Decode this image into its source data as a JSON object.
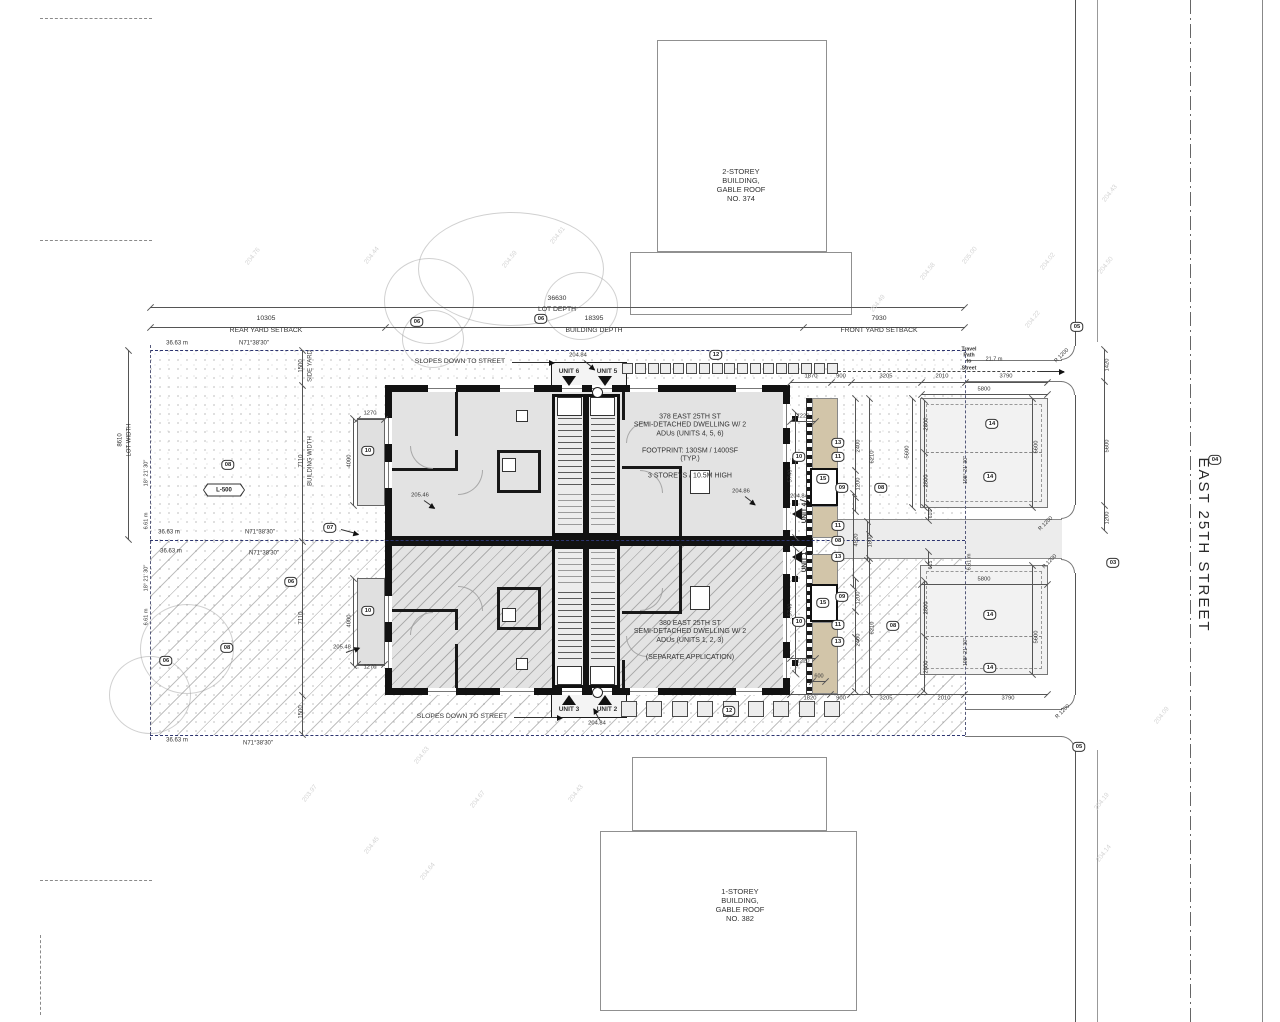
{
  "street": {
    "name": "EAST 25TH STREET"
  },
  "neighbors": {
    "north": "2-STOREY\nBUILDING,\nGABLE ROOF\nNO. 374",
    "south": "1-STOREY\nBUILDING,\nGABLE ROOF\nNO. 382"
  },
  "buildings": {
    "north": {
      "text": "378 EAST 25TH ST\nSEMI-DETACHED DWELLING W/ 2\nADUs (UNITS 4, 5, 6)\n\nFOOTPRINT: 130SM / 1400SF\n(TYP.)\n\n3 STOREYS / 10.5M HIGH"
    },
    "south": {
      "text": "380 EAST 25TH ST\nSEMI-DETACHED DWELLING W/ 2\nADUs (UNITS 1, 2, 3)\n\n(SEPARATE APPLICATION)"
    }
  },
  "travel": {
    "label": "Travel\nPath\nto\nStreet",
    "distance": "21.7 m"
  },
  "labels": [
    {
      "t": "36630",
      "x": 557,
      "y": 299
    },
    {
      "t": "LOT DEPTH",
      "x": 557,
      "y": 310
    },
    {
      "t": "10305",
      "x": 266,
      "y": 319
    },
    {
      "t": "REAR YARD SETBACK",
      "x": 266,
      "y": 331
    },
    {
      "t": "18395",
      "x": 594,
      "y": 319
    },
    {
      "t": "BUILDING DEPTH",
      "x": 594,
      "y": 331
    },
    {
      "t": "7930",
      "x": 879,
      "y": 319
    },
    {
      "t": "FRONT YARD SETBACK",
      "x": 879,
      "y": 331
    },
    {
      "t": "36.63 m",
      "x": 177,
      "y": 344,
      "s": 6
    },
    {
      "t": "N71°38'30\"",
      "x": 254,
      "y": 344,
      "s": 6
    },
    {
      "t": "36.63 m",
      "x": 169,
      "y": 533,
      "s": 6
    },
    {
      "t": "N71°38'30\"",
      "x": 260,
      "y": 533,
      "s": 6
    },
    {
      "t": "36.63 m",
      "x": 171,
      "y": 552,
      "s": 6
    },
    {
      "t": "N71°38'30\"",
      "x": 264,
      "y": 554,
      "s": 6
    },
    {
      "t": "36.63 m",
      "x": 177,
      "y": 741,
      "s": 6
    },
    {
      "t": "N71°38'30\"",
      "x": 258,
      "y": 744,
      "s": 6
    },
    {
      "t": "8610",
      "x": 121,
      "y": 440,
      "r": -90,
      "s": 6
    },
    {
      "t": "LOT WIDTH",
      "x": 130,
      "y": 440,
      "r": -90,
      "s": 6
    },
    {
      "t": "18° 21' 30\"",
      "x": 147,
      "y": 473,
      "r": -90,
      "s": 5.5
    },
    {
      "t": "6.61 m",
      "x": 147,
      "y": 521,
      "r": -90,
      "s": 5.5
    },
    {
      "t": "18° 21' 30\"",
      "x": 147,
      "y": 578,
      "r": -90,
      "s": 5.5
    },
    {
      "t": "6.61 m",
      "x": 147,
      "y": 617,
      "r": -90,
      "s": 5.5
    },
    {
      "t": "6.61 m",
      "x": 970,
      "y": 562,
      "r": -90,
      "s": 5.5
    },
    {
      "t": "1500",
      "x": 302,
      "y": 366,
      "r": -90,
      "s": 6
    },
    {
      "t": "SIDE YARD",
      "x": 311,
      "y": 366,
      "r": -90,
      "s": 6
    },
    {
      "t": "7110",
      "x": 302,
      "y": 461,
      "r": -90,
      "s": 6
    },
    {
      "t": "BUILDING WIDTH",
      "x": 311,
      "y": 461,
      "r": -90,
      "s": 6
    },
    {
      "t": "7110",
      "x": 302,
      "y": 618,
      "r": -90,
      "s": 6
    },
    {
      "t": "1500",
      "x": 302,
      "y": 712,
      "r": -90,
      "s": 6
    },
    {
      "t": "SLOPES DOWN TO STREET",
      "x": 460,
      "y": 362
    },
    {
      "t": "SLOPES DOWN TO STREET",
      "x": 462,
      "y": 717
    },
    {
      "t": "UNIT 6",
      "x": 569,
      "y": 372,
      "s": 6.5,
      "b": 1
    },
    {
      "t": "UNIT 5",
      "x": 607,
      "y": 372,
      "s": 6.5,
      "b": 1
    },
    {
      "t": "UNIT 3",
      "x": 569,
      "y": 710,
      "s": 6.5,
      "b": 1
    },
    {
      "t": "UNIT 2",
      "x": 607,
      "y": 710,
      "s": 6.5,
      "b": 1
    },
    {
      "t": "UNIT 4",
      "x": 805,
      "y": 513,
      "r": -90,
      "s": 6.5,
      "b": 1
    },
    {
      "t": "UNIT 1",
      "x": 805,
      "y": 562,
      "r": -90,
      "s": 6.5,
      "b": 1
    },
    {
      "t": "204.84",
      "x": 578,
      "y": 356,
      "s": 5.8
    },
    {
      "t": "204.86",
      "x": 741,
      "y": 492,
      "s": 5.8
    },
    {
      "t": "204.84",
      "x": 799,
      "y": 497,
      "s": 5.8
    },
    {
      "t": "205.46",
      "x": 420,
      "y": 496,
      "s": 5.8
    },
    {
      "t": "205.48",
      "x": 342,
      "y": 648,
      "s": 5.8
    },
    {
      "t": "204.84",
      "x": 597,
      "y": 724,
      "s": 5.8
    },
    {
      "t": "1220",
      "x": 803,
      "y": 417,
      "s": 5.8
    },
    {
      "t": "5740",
      "x": 791,
      "y": 476,
      "r": -90,
      "s": 5.8
    },
    {
      "t": "1220",
      "x": 803,
      "y": 662,
      "s": 5.8
    },
    {
      "t": "5740",
      "x": 791,
      "y": 610,
      "r": -90,
      "s": 5.8
    },
    {
      "t": "2400",
      "x": 859,
      "y": 446,
      "r": -90,
      "s": 5.8
    },
    {
      "t": "1200",
      "x": 859,
      "y": 484,
      "r": -90,
      "s": 5.8
    },
    {
      "t": "6210",
      "x": 873,
      "y": 457,
      "r": -90,
      "s": 5.8
    },
    {
      "t": "4520",
      "x": 857,
      "y": 540,
      "r": -90,
      "s": 5.8
    },
    {
      "t": "1800",
      "x": 871,
      "y": 541,
      "r": -90,
      "s": 5.8
    },
    {
      "t": "1200",
      "x": 859,
      "y": 598,
      "r": -90,
      "s": 5.8
    },
    {
      "t": "2400",
      "x": 859,
      "y": 640,
      "r": -90,
      "s": 5.8
    },
    {
      "t": "6210",
      "x": 873,
      "y": 628,
      "r": -90,
      "s": 5.8
    },
    {
      "t": "600",
      "x": 819,
      "y": 677,
      "s": 5.5
    },
    {
      "t": "1870",
      "x": 811,
      "y": 377,
      "s": 5.8
    },
    {
      "t": "900",
      "x": 841,
      "y": 377,
      "s": 5.8
    },
    {
      "t": "3205",
      "x": 886,
      "y": 377,
      "s": 5.8
    },
    {
      "t": "2010",
      "x": 942,
      "y": 377,
      "s": 5.8
    },
    {
      "t": "3790",
      "x": 1006,
      "y": 377,
      "s": 5.8
    },
    {
      "t": "5800",
      "x": 984,
      "y": 390,
      "s": 5.8
    },
    {
      "t": "1820",
      "x": 810,
      "y": 699,
      "s": 5.8
    },
    {
      "t": "900",
      "x": 841,
      "y": 699,
      "s": 5.8
    },
    {
      "t": "3205",
      "x": 886,
      "y": 699,
      "s": 5.8
    },
    {
      "t": "2010",
      "x": 944,
      "y": 699,
      "s": 5.8
    },
    {
      "t": "3790",
      "x": 1008,
      "y": 699,
      "s": 5.8
    },
    {
      "t": "5800",
      "x": 984,
      "y": 580,
      "s": 5.8
    },
    {
      "t": "2800",
      "x": 927,
      "y": 424,
      "r": -90,
      "s": 5.8
    },
    {
      "t": "2800",
      "x": 927,
      "y": 481,
      "r": -90,
      "s": 5.8
    },
    {
      "t": "5600",
      "x": 1037,
      "y": 447,
      "r": -90,
      "s": 5.8
    },
    {
      "t": "5600",
      "x": 908,
      "y": 452,
      "r": -90,
      "s": 5.8
    },
    {
      "t": "610",
      "x": 931,
      "y": 514,
      "r": -90,
      "s": 5.2
    },
    {
      "t": "615",
      "x": 931,
      "y": 565,
      "r": -90,
      "s": 5.2
    },
    {
      "t": "2800",
      "x": 927,
      "y": 608,
      "r": -90,
      "s": 5.8
    },
    {
      "t": "2800",
      "x": 927,
      "y": 667,
      "r": -90,
      "s": 5.8
    },
    {
      "t": "5600",
      "x": 1037,
      "y": 637,
      "r": -90,
      "s": 5.8
    },
    {
      "t": "198° 21' 30\"",
      "x": 966,
      "y": 470,
      "r": -90,
      "s": 5.2
    },
    {
      "t": "198° 21' 30\"",
      "x": 966,
      "y": 652,
      "r": -90,
      "s": 5.2
    },
    {
      "t": "1270",
      "x": 370,
      "y": 414,
      "s": 5.8
    },
    {
      "t": "4000",
      "x": 350,
      "y": 461,
      "r": -90,
      "s": 5.8
    },
    {
      "t": "1270",
      "x": 370,
      "y": 668,
      "s": 5.8
    },
    {
      "t": "4000",
      "x": 350,
      "y": 621,
      "r": -90,
      "s": 5.8
    },
    {
      "t": "1420",
      "x": 1108,
      "y": 365,
      "r": -90,
      "s": 5.8
    },
    {
      "t": "5600",
      "x": 1108,
      "y": 446,
      "r": -90,
      "s": 5.8
    },
    {
      "t": "1200",
      "x": 1108,
      "y": 518,
      "r": -90,
      "s": 5.8
    },
    {
      "t": "R 1200",
      "x": 1062,
      "y": 356,
      "r": -45,
      "s": 5.5
    },
    {
      "t": "R 1200",
      "x": 1046,
      "y": 524,
      "r": -45,
      "s": 5.5
    },
    {
      "t": "R 1200",
      "x": 1050,
      "y": 562,
      "r": -45,
      "s": 5.5
    },
    {
      "t": "R 1200",
      "x": 1063,
      "y": 712,
      "r": -45,
      "s": 5.5
    }
  ],
  "keynotes": [
    {
      "n": "06",
      "x": 417,
      "y": 322
    },
    {
      "n": "06",
      "x": 541,
      "y": 319
    },
    {
      "n": "08",
      "x": 228,
      "y": 465
    },
    {
      "n": "L-500",
      "x": 224,
      "y": 490,
      "hex": 1
    },
    {
      "n": "07",
      "x": 330,
      "y": 528
    },
    {
      "n": "06",
      "x": 291,
      "y": 582
    },
    {
      "n": "08",
      "x": 227,
      "y": 648
    },
    {
      "n": "06",
      "x": 166,
      "y": 661
    },
    {
      "n": "12",
      "x": 716,
      "y": 355
    },
    {
      "n": "12",
      "x": 729,
      "y": 711
    },
    {
      "n": "10",
      "x": 368,
      "y": 451
    },
    {
      "n": "10",
      "x": 368,
      "y": 611
    },
    {
      "n": "10",
      "x": 799,
      "y": 457
    },
    {
      "n": "10",
      "x": 799,
      "y": 622
    },
    {
      "n": "13",
      "x": 838,
      "y": 443
    },
    {
      "n": "11",
      "x": 838,
      "y": 457
    },
    {
      "n": "15",
      "x": 823,
      "y": 479
    },
    {
      "n": "09",
      "x": 842,
      "y": 488
    },
    {
      "n": "08",
      "x": 881,
      "y": 488
    },
    {
      "n": "11",
      "x": 838,
      "y": 526
    },
    {
      "n": "08",
      "x": 838,
      "y": 541
    },
    {
      "n": "13",
      "x": 838,
      "y": 557
    },
    {
      "n": "09",
      "x": 842,
      "y": 597
    },
    {
      "n": "15",
      "x": 823,
      "y": 603
    },
    {
      "n": "11",
      "x": 838,
      "y": 625
    },
    {
      "n": "13",
      "x": 838,
      "y": 642
    },
    {
      "n": "14",
      "x": 992,
      "y": 424
    },
    {
      "n": "14",
      "x": 990,
      "y": 477
    },
    {
      "n": "14",
      "x": 990,
      "y": 615
    },
    {
      "n": "14",
      "x": 990,
      "y": 668
    },
    {
      "n": "08",
      "x": 893,
      "y": 626
    },
    {
      "n": "05",
      "x": 1077,
      "y": 327
    },
    {
      "n": "04",
      "x": 1215,
      "y": 460
    },
    {
      "n": "03",
      "x": 1113,
      "y": 563
    },
    {
      "n": "05",
      "x": 1079,
      "y": 747
    }
  ],
  "marks": [
    {
      "t": "204.76",
      "x": 243,
      "y": 253
    },
    {
      "t": "204.44",
      "x": 362,
      "y": 252
    },
    {
      "t": "204.59",
      "x": 500,
      "y": 256
    },
    {
      "t": "204.61",
      "x": 548,
      "y": 232
    },
    {
      "t": "204.49",
      "x": 868,
      "y": 300
    },
    {
      "t": "204.58",
      "x": 918,
      "y": 268
    },
    {
      "t": "204.22",
      "x": 1023,
      "y": 316
    },
    {
      "t": "204.43",
      "x": 1100,
      "y": 190
    },
    {
      "t": "204.50",
      "x": 1096,
      "y": 262
    },
    {
      "t": "203.97",
      "x": 300,
      "y": 790
    },
    {
      "t": "204.63",
      "x": 412,
      "y": 752
    },
    {
      "t": "204.45",
      "x": 362,
      "y": 842
    },
    {
      "t": "204.67",
      "x": 468,
      "y": 796
    },
    {
      "t": "204.64",
      "x": 418,
      "y": 868
    },
    {
      "t": "204.43",
      "x": 566,
      "y": 790
    },
    {
      "t": "204.19",
      "x": 1092,
      "y": 798
    },
    {
      "t": "204.14",
      "x": 1094,
      "y": 850
    },
    {
      "t": "204.09",
      "x": 1152,
      "y": 712
    },
    {
      "t": "205.00",
      "x": 960,
      "y": 252
    },
    {
      "t": "204.02",
      "x": 1038,
      "y": 258
    }
  ],
  "trees": [
    {
      "x": 510,
      "y": 268,
      "rx": 92,
      "ry": 56
    },
    {
      "x": 428,
      "y": 300,
      "rx": 44,
      "ry": 42
    },
    {
      "x": 580,
      "y": 305,
      "rx": 36,
      "ry": 33
    },
    {
      "x": 432,
      "y": 338,
      "rx": 30,
      "ry": 28
    },
    {
      "x": 470,
      "y": 598,
      "rx": 78,
      "ry": 58
    },
    {
      "x": 186,
      "y": 648,
      "rx": 46,
      "ry": 44
    },
    {
      "x": 149,
      "y": 694,
      "rx": 40,
      "ry": 38
    }
  ],
  "arrows": [
    {
      "x": 512,
      "y": 362,
      "len": 42,
      "r": 0
    },
    {
      "x": 514,
      "y": 717,
      "len": 48,
      "r": 0
    },
    {
      "x": 1040,
      "y": 371,
      "len": 24,
      "r": 0
    },
    {
      "x": 341,
      "y": 529,
      "len": 18,
      "r": 15
    },
    {
      "x": 584,
      "y": 360,
      "len": 14,
      "r": 40
    },
    {
      "x": 745,
      "y": 496,
      "len": 13,
      "r": 38
    },
    {
      "x": 800,
      "y": 499,
      "len": 12,
      "r": 20
    },
    {
      "x": 424,
      "y": 500,
      "len": 13,
      "r": 35
    },
    {
      "x": 346,
      "y": 652,
      "len": 14,
      "r": -20
    },
    {
      "x": 600,
      "y": 720,
      "len": 13,
      "r": -120
    }
  ],
  "pavers": [
    {
      "x": 622,
      "y": 363,
      "n": 17,
      "size": 11,
      "pitch": 12.8
    },
    {
      "x": 621,
      "y": 701,
      "n": 9,
      "size": 16,
      "pitch": 25.4
    }
  ]
}
